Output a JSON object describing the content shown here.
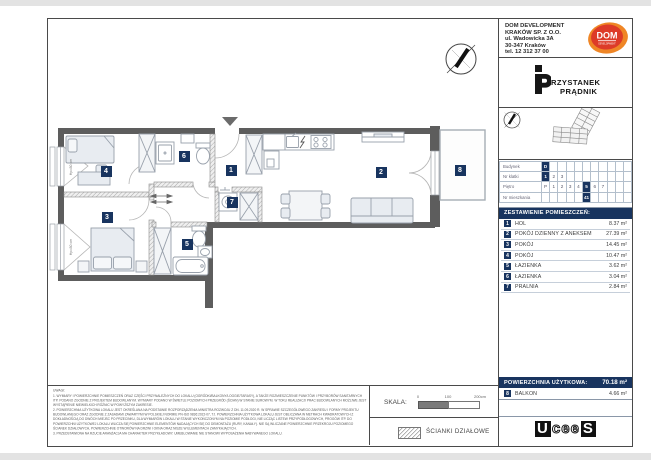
{
  "colors": {
    "navy": "#18345f",
    "wall_gray": "#5d5d5d",
    "dom_orange": "#ef8626",
    "dom_red": "#dd3b28"
  },
  "icons": {
    "north_arrow": "compass-icon",
    "entrance_marker": "triangle-down-icon",
    "partition_hatch": "diagonal-hatch-swatch"
  },
  "header": {
    "company_lines": [
      "DOM DEVELOPMENT",
      "KRAKÓW SP. Z O.O.",
      "ul. Wadowicka 3A",
      "30-347 Kraków",
      "tel. 12 312 37 00"
    ],
    "dom_logo": {
      "text": "DOM",
      "subtext": "DEVELOPMENT"
    },
    "project_logo": {
      "line1": "RZYSTANEK",
      "line2": "PRĄDNIK"
    }
  },
  "unit_table": {
    "rows": [
      {
        "label": "Budynek",
        "cells": [
          "D",
          "",
          "",
          "",
          "",
          "",
          "",
          "",
          "",
          "",
          ""
        ],
        "highlight": 0
      },
      {
        "label": "Nr klatki",
        "cells": [
          "1",
          "2",
          "3",
          "",
          "",
          "",
          "",
          "",
          "",
          "",
          ""
        ],
        "highlight": 0
      },
      {
        "label": "Piętro",
        "cells": [
          "P",
          "1",
          "2",
          "3",
          "4",
          "5",
          "6",
          "7",
          "",
          "",
          ""
        ],
        "highlight": 5
      },
      {
        "label": "Nr mieszkania",
        "cells": [
          "",
          "",
          "",
          "",
          "",
          "41",
          "",
          "",
          "",
          "",
          ""
        ],
        "highlight": 5
      }
    ]
  },
  "rooms": {
    "title": "ZESTAWIENIE POMIESZCZEŃ:",
    "items": [
      {
        "no": "1",
        "name": "HOL",
        "area": "8.37 m²"
      },
      {
        "no": "2",
        "name": "POKÓJ DZIENNY Z ANEKSEM",
        "area": "27.39 m²"
      },
      {
        "no": "3",
        "name": "POKÓJ",
        "area": "14.45 m²"
      },
      {
        "no": "4",
        "name": "POKÓJ",
        "area": "10.47 m²"
      },
      {
        "no": "5",
        "name": "ŁAZIENKA",
        "area": "3.62 m²"
      },
      {
        "no": "6",
        "name": "ŁAZIENKA",
        "area": "3.04 m²"
      },
      {
        "no": "7",
        "name": "PRALNIA",
        "area": "2.84 m²"
      }
    ]
  },
  "summary": {
    "label": "POWIERZCHNIA UŻYTKOWA:",
    "value": "70.18 m²",
    "balcony": {
      "no": "8",
      "name": "BALKON",
      "area": "4.66 m²"
    }
  },
  "plan": {
    "badges": [
      {
        "no": "1",
        "x": 231,
        "y": 170
      },
      {
        "no": "2",
        "x": 381,
        "y": 172
      },
      {
        "no": "3",
        "x": 107,
        "y": 217
      },
      {
        "no": "4",
        "x": 106,
        "y": 171
      },
      {
        "no": "5",
        "x": 187,
        "y": 244
      },
      {
        "no": "6",
        "x": 184,
        "y": 156
      },
      {
        "no": "7",
        "x": 232,
        "y": 202
      },
      {
        "no": "8",
        "x": 460,
        "y": 170
      }
    ],
    "window_labels": [
      {
        "text": "Hp=80 cm",
        "x": 71,
        "y": 167
      },
      {
        "text": "Hp=80 cm",
        "x": 71,
        "y": 247
      }
    ]
  },
  "notes": {
    "title": "UWAGI:",
    "items": [
      "1. WYMIARY I POWIERZCHNIE POMIESZCZEŃ ORAZ CZĘŚCI PRZYNALEŻNYCH DO LOKALU (OGRÓDKI/BALKONY/LOGGIE/TARASY), A TAKŻE ROZMIESZCZENIE PUNKTÓW I PRZYBORÓW SANITARNYCH ITP. PODANO ZGODNIE Z PROJEKTEM BUDOWLANYM. WYMIARY PODANO W ŚWIETLE POZIOMYCH PRZEGRÓD (ŚCIAN) W STANIE SUROWYM. W TOKU REALIZACJI PRAC BUDOWLANYCH MOŻLIWE JEST WYSTĄPIENIE NIEWIELKICH RÓŻNIC W POWYŻSZYM ZAKRESIE.",
      "2. POWIERZCHNIA UŻYTKOWA LOKALU JEST OKREŚLANA NA PODSTAWIE ROZPORZĄDZENIA MINISTRA ROZWOJU Z DN. 11.09.2020 R. W SPRAWIE SZCZEGÓŁOWEGO ZAKRESU I FORMY PROJEKTU BUDOWLANEGO ORAZ ZGODNIE Z ZASADAMI ZAWARTYMI W POLSKIEJ NORMIE PN-ISO 9836:2022-07, TJ. POWIERZCHNIA UŻYTKOWA LOKALU JEST OBLICZANA W METRACH KWADRATOWYCH Z DOKŁADNOŚCIĄ DO DWÓCH MIEJSC PO PRZECINKU, DLA WYMIARÓW LOKALU W STANIE WYKOŃCZONYM NA POZIOMIE PODŁOGI, NIE LICZĄC LISTEW PRZYPODŁOGOWYCH, PROGÓW ITP. DO POWIERZCHNI UŻYTKOWEJ LOKALU WLICZA SIĘ POWIERZCHNIE ELEMENTÓW NADAJĄCYCH SIĘ DO DEMONTAŻU (RURY, KANAŁY). NIE SĄ WLICZANE POWIERZCHNIE PRZEKROJU POZIOMEGO ŚCIANEK DZIAŁOWYCH, POWIERZCHNIE OTWORÓW NA DRZWI I OKNA ORAZ NISZE W ELEMENTACH ZAMYKAJĄCYCH.",
      "3. PRZEDSTAWIONA NA RZUCIE ARANŻACJA MA CHARAKTER PRZYKŁADOWY. UMEBLOWANIE NIE STANOWI WYPOSAŻENIA NABYWANEGO LOKALU."
    ]
  },
  "scale": {
    "label": "SKALA:",
    "ticks": [
      "0",
      "100",
      "200cm"
    ]
  },
  "legend": {
    "partition_label": "ŚCIANKI DZIAŁOWE"
  },
  "footer_logo": {
    "pre": "U",
    "mid": "cee",
    "post": "S"
  }
}
